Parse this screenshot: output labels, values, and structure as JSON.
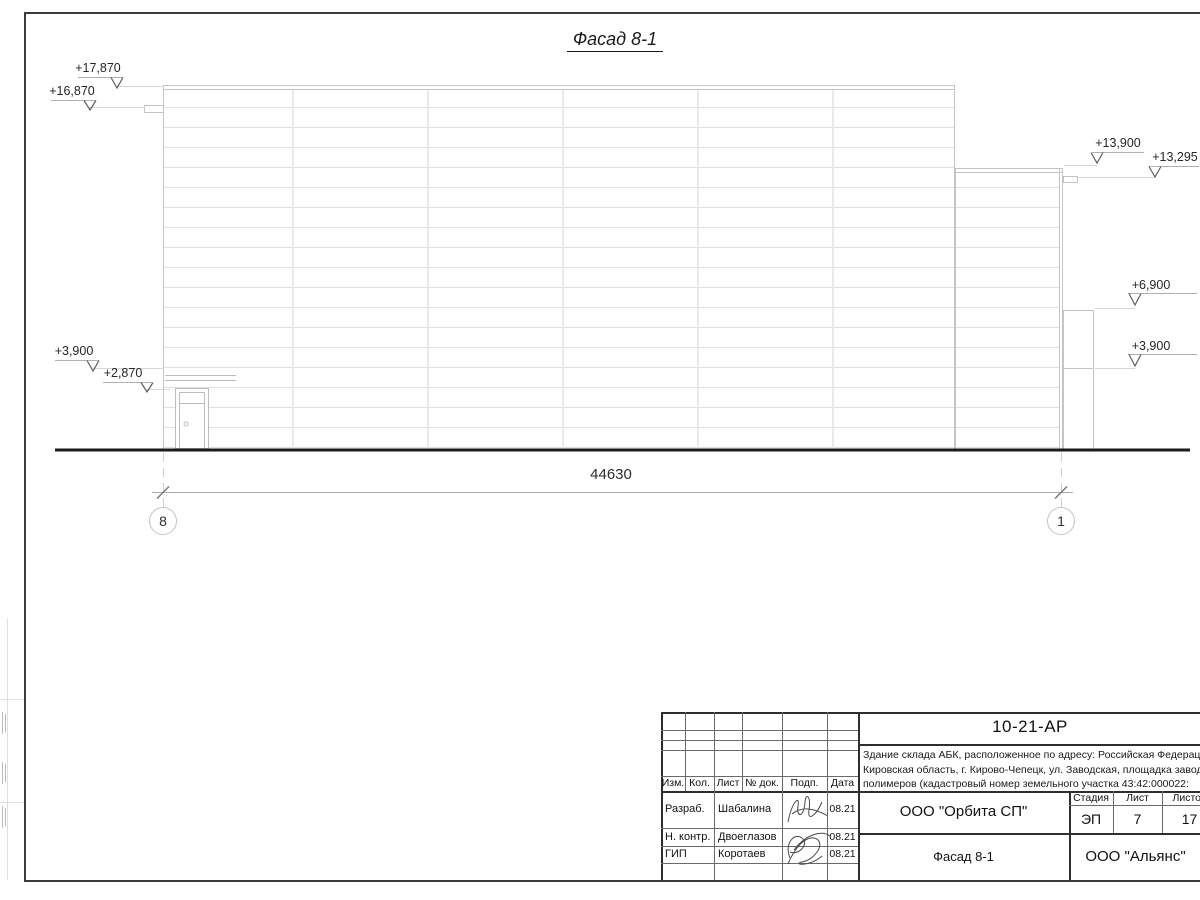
{
  "drawing": {
    "title": "Фасад 8-1",
    "dimension_total": "44630",
    "axis_left": "8",
    "axis_right": "1",
    "elevation_marks": [
      {
        "label": "+17,870",
        "tx": 98,
        "ty": 69,
        "shelf": [
          78,
          123
        ],
        "sy": 77,
        "ax": 117,
        "ly": 88,
        "leader": [
          117,
          164,
          86
        ]
      },
      {
        "label": "+16,870",
        "tx": 72,
        "ty": 92,
        "shelf": [
          51,
          96
        ],
        "sy": 100,
        "ax": 90,
        "ly": 110,
        "leader": [
          90,
          145,
          107
        ]
      },
      {
        "label": "+3,900",
        "tx": 74,
        "ty": 352,
        "shelf": [
          55,
          99
        ],
        "sy": 360,
        "ax": 93,
        "ly": 371,
        "leader": [
          93,
          164,
          368
        ]
      },
      {
        "label": "+2,870",
        "tx": 123,
        "ty": 374,
        "shelf": [
          103,
          152
        ],
        "sy": 382,
        "ax": 147,
        "ly": 392,
        "leader": [
          147,
          170,
          389
        ]
      },
      {
        "label": "+13,900",
        "tx": 1118,
        "ty": 144,
        "shelf": [
          1092,
          1144
        ],
        "sy": 152,
        "ax": 1097,
        "ly": 163,
        "leader": [
          1064,
          1097,
          165
        ]
      },
      {
        "label": "+13,295",
        "tx": 1175,
        "ty": 158,
        "shelf": [
          1149,
          1199
        ],
        "sy": 166,
        "ax": 1155,
        "ly": 177,
        "leader": [
          1078,
          1155,
          177
        ]
      },
      {
        "label": "+6,900",
        "tx": 1151,
        "ty": 286,
        "shelf": [
          1128,
          1197
        ],
        "sy": 293,
        "ax": 1135,
        "ly": 305,
        "leader": [
          1095,
          1135,
          308
        ]
      },
      {
        "label": "+3,900",
        "tx": 1151,
        "ty": 347,
        "shelf": [
          1128,
          1197
        ],
        "sy": 354,
        "ax": 1135,
        "ly": 366,
        "leader": [
          1095,
          1135,
          368
        ]
      }
    ]
  },
  "title_block": {
    "doc_number": "10-21-АР",
    "description_lines": [
      "Здание склада АБК, расположенное по адресу: Российская Федерация,",
      "Кировская область, г. Кирово-Чепецк, ул. Заводская, площадка завода",
      "полимеров (кадастровый номер земельного участка 43:42:000022:"
    ],
    "rev_header": [
      "Изм.",
      "Кол.",
      "Лист",
      "№ док.",
      "Подп.",
      "Дата"
    ],
    "signature_rows": [
      {
        "role": "Разраб.",
        "name": "Шабалина",
        "date": "08.21"
      },
      {
        "role": "Н. контр.",
        "name": "Двоеглазов",
        "date": "08.21"
      },
      {
        "role": "ГИП",
        "name": "Коротаев",
        "date": "08.21"
      }
    ],
    "stage_header": [
      "Стадия",
      "Лист",
      "Листов"
    ],
    "stage_values": [
      "ЭП",
      "7",
      "17"
    ],
    "company": "ООО \"Орбита СП\"",
    "sheet_title": "Фасад 8-1",
    "contractor": "ООО \"Альянс\""
  }
}
